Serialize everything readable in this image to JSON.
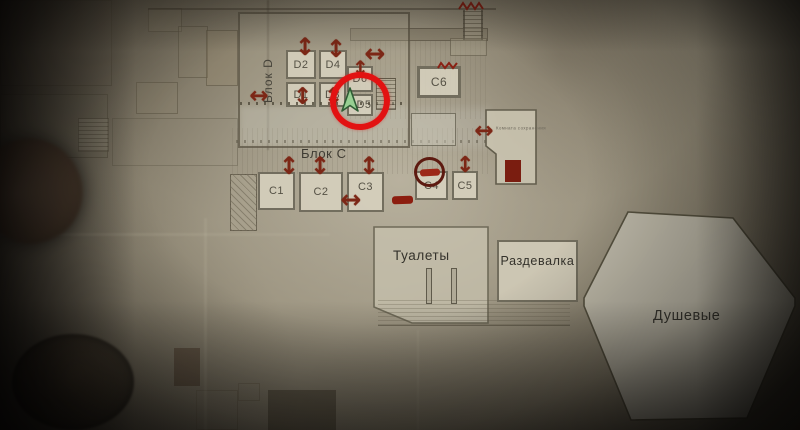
{
  "map": {
    "block_d": {
      "label": "Блок D",
      "rooms": {
        "d1": "D1",
        "d2": "D2",
        "d3": "D3",
        "d4": "D4",
        "d5": "D5",
        "d6": "D6"
      }
    },
    "block_c": {
      "label": "Блок C",
      "rooms": {
        "c1": "C1",
        "c2": "C2",
        "c3": "C3",
        "c4": "C4",
        "c5": "C5",
        "c6": "C6"
      }
    },
    "areas": {
      "toilets": "Туалеты",
      "changing_room": "Раздевалка",
      "showers": "Душевые",
      "save_room": "Комната сохранения"
    },
    "icons": {
      "door_vertical": "↕",
      "door_horizontal": "↔"
    },
    "colors": {
      "annotation_red": "#7c2716",
      "highlight_red": "#e21212",
      "blocked_red": "#8c1d0f",
      "player_green": "#97cf92",
      "paper_light": "#b5ac97",
      "room_fill": "#d8d2c0",
      "wall_gray": "#6b6554",
      "ink": "#3f3c33"
    }
  }
}
